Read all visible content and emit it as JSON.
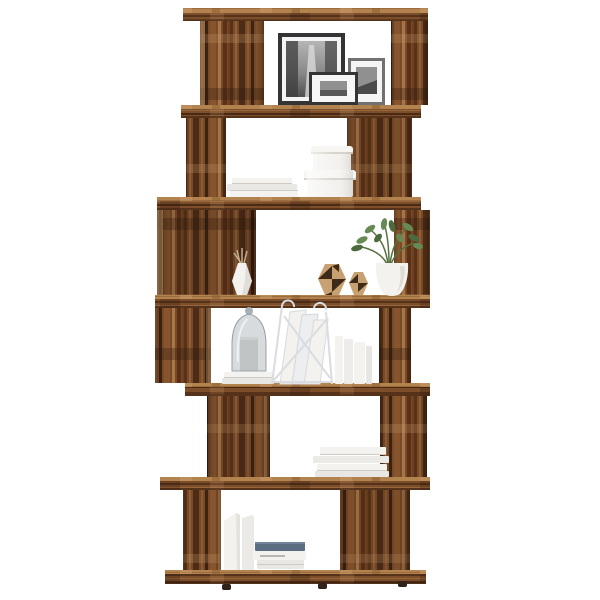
{
  "scene": {
    "type": "product-photo",
    "subject": "Six-tier zigzag rustic wood room-divider bookshelf styled with decor on a white background",
    "background": "white seamless backdrop",
    "furniture": {
      "material": "rustic reclaimed-look wood",
      "tier_count": 6,
      "style": "zigzag / S-shaped open book cabinet with small feet"
    }
  },
  "colors": {
    "background": "#ffffff",
    "wood_base": "#7a4a27",
    "wood_dark_streak": "#4c2c17",
    "wood_mid_streak": "#8a5a34",
    "wood_light_streak": "#a5764a",
    "wood_top_face": "#b2824f",
    "wood_edge_dark": "#3a2112",
    "feet_dark": "#32231a",
    "white_item": "#f3f2ef",
    "white_item_shade": "#dedbd5",
    "book_blue": "#5c6d82",
    "frame_black": "#343436",
    "frame_gray": "#717173",
    "photo_gray": "#909090",
    "photo_dark": "#4a4a4a",
    "glass_gray": "#a7afb6",
    "candle_gray": "#d7d5d1",
    "ornament_tan": "#c8a173",
    "ornament_dark": "#3e2a18",
    "plant_green": "#678a54",
    "plant_green_dark": "#4c6b3c",
    "twig_tan": "#c4ae8e",
    "wire_gray": "#d9dce0"
  },
  "tiers": [
    {
      "name": "tier-1-top",
      "items": [
        {
          "type": "picture-frame",
          "desc": "large black frame, black-and-white city street photo"
        },
        {
          "type": "picture-frame",
          "desc": "wide white-matted black frame, small black-and-white skyline photo"
        },
        {
          "type": "picture-frame",
          "desc": "gray frame, small black-and-white coastal photo"
        }
      ]
    },
    {
      "name": "tier-2",
      "items": [
        {
          "type": "book-stack",
          "count": 3,
          "color": "white",
          "orientation": "flat"
        },
        {
          "type": "round-storage-boxes",
          "count": 2,
          "color": "white",
          "arrangement": "stacked with lids"
        }
      ]
    },
    {
      "name": "tier-3",
      "items": [
        {
          "type": "faceted-vase",
          "color": "white",
          "contents": "dried twigs"
        },
        {
          "type": "geometric-ornaments",
          "count": 2,
          "colors": [
            "tan",
            "dark brown"
          ],
          "pattern": "diamond facets"
        },
        {
          "type": "potted-plant",
          "pot_color": "white",
          "foliage": "green artificial plant"
        }
      ]
    },
    {
      "name": "tier-4",
      "items": [
        {
          "type": "glass-cloche",
          "contents": "gray pillar candle",
          "base": "two white books"
        },
        {
          "type": "wire-magazine-rack",
          "color": "white",
          "contents": "white papers and cards"
        },
        {
          "type": "leaning-books",
          "count": 4,
          "color": "white"
        }
      ]
    },
    {
      "name": "tier-5",
      "items": [
        {
          "type": "book-stack",
          "count": 4,
          "color": "white",
          "orientation": "flat"
        }
      ]
    },
    {
      "name": "tier-6-bottom",
      "items": [
        {
          "type": "magazine-file-boxes",
          "count": 2,
          "color": "white"
        },
        {
          "type": "book-stack",
          "count": 3,
          "colors": [
            "blue-gray",
            "white",
            "white"
          ],
          "orientation": "flat"
        }
      ]
    }
  ]
}
